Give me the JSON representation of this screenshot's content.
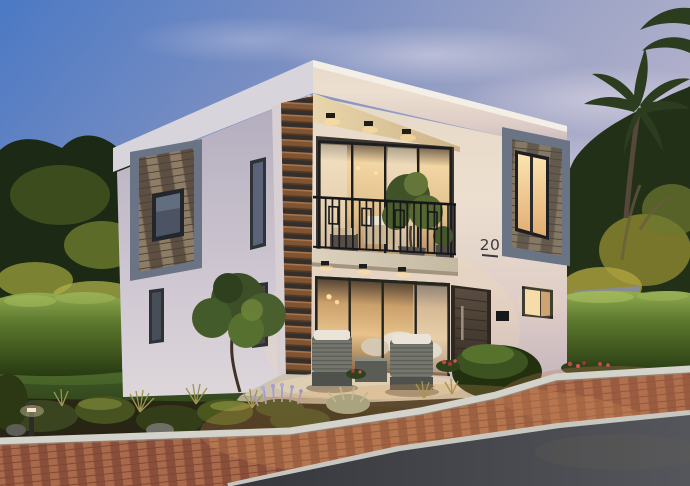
{
  "scene": {
    "type": "exterior-architectural-visualization",
    "subject": "Modern two-storey detached villa at dusk",
    "time_of_day": "dusk",
    "elements": [
      "twilight sky",
      "tropical trees",
      "palm tree",
      "trimmed hedges",
      "front lawn",
      "flower bed",
      "brick paved street",
      "asphalt road",
      "bollard path light"
    ]
  },
  "house": {
    "number": "20",
    "floors": 2,
    "features": [
      "flat roof",
      "vertical wood slat screen",
      "balcony with black metal railing",
      "stone accent panels",
      "floor-to-ceiling glazing",
      "warm interior lighting",
      "dark entry door",
      "patio with outdoor lounge chairs",
      "intercom panel",
      "soffit downlights"
    ]
  },
  "colors": {
    "sky_top": "#4b79c4",
    "sky_horizon": "#bab6ce",
    "facade_warm": "#ecdfcf",
    "facade_shadow": "#c3bcc9",
    "roof_fascia": "#f1ebe1",
    "wood_slat": "#7e5433",
    "stone_accent": "#746a5c",
    "accent_frame": "#6b7484",
    "window_glow": "#f7dcab",
    "railing": "#17181a",
    "door": "#4a4136",
    "hedge": "#5d7a2e",
    "lawn": "#2c3f17",
    "tree_highlight": "#a89a34",
    "brick_paving": "#9c5c44",
    "curb": "#d3d2cb",
    "asphalt": "#3f4146",
    "balcony_slab": "#d7cdb9",
    "lavender": "#a79ccb",
    "number_color": "#3a3a44"
  }
}
